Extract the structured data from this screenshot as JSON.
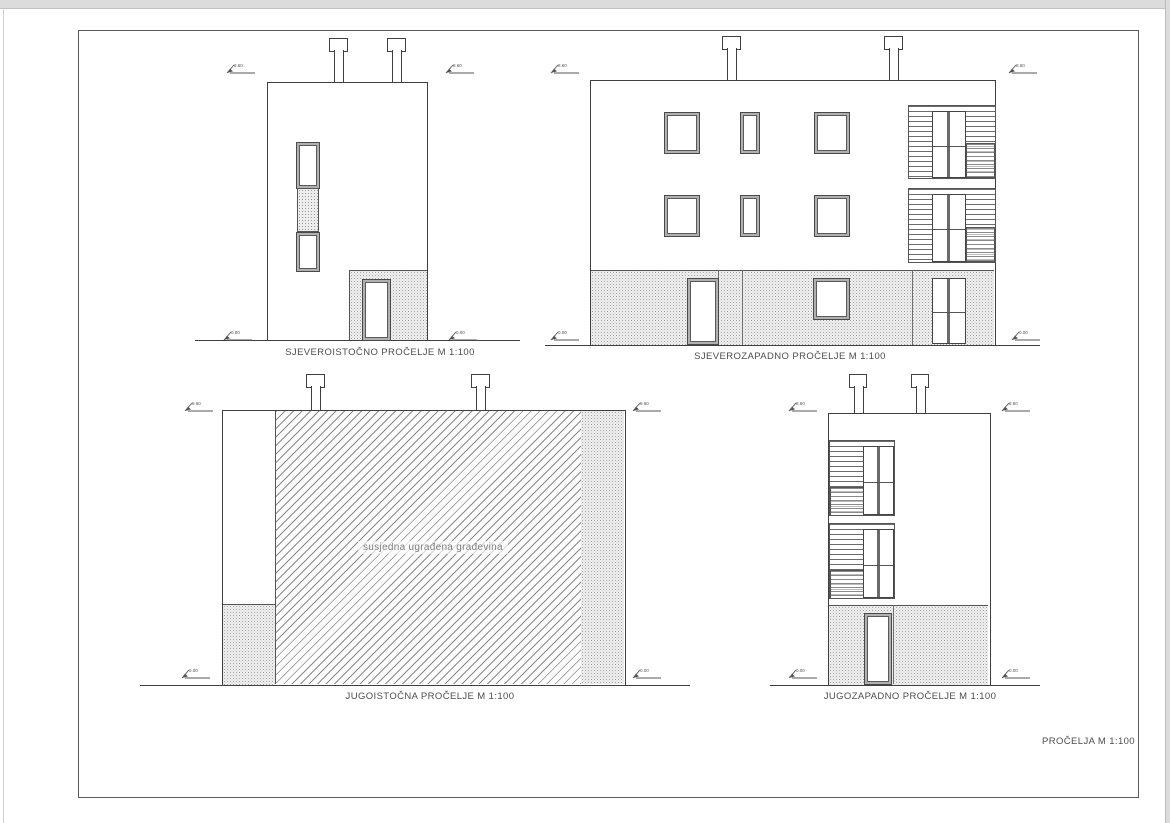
{
  "sheet": {
    "corner_label": "PROČELJA M 1:100"
  },
  "elevations": {
    "ne": {
      "label": "SJEVEROISTOČNO PROČELJE M 1:100"
    },
    "nw": {
      "label": "SJEVEROZAPADNO PROČELJE M 1:100"
    },
    "se": {
      "label": "JUGOISTOČNA PROČELJE M 1:100",
      "annotation": "susjedna ugrađena građevina"
    },
    "sw": {
      "label": "JUGOZAPADNO PROČELJE M 1:100"
    }
  },
  "markers": {
    "top": "8.60",
    "bottom": "0.00"
  },
  "colors": {
    "line": "#3f3f3f",
    "text": "#4d4d4d",
    "paper": "#ffffff",
    "background": "#dcdcdc"
  }
}
